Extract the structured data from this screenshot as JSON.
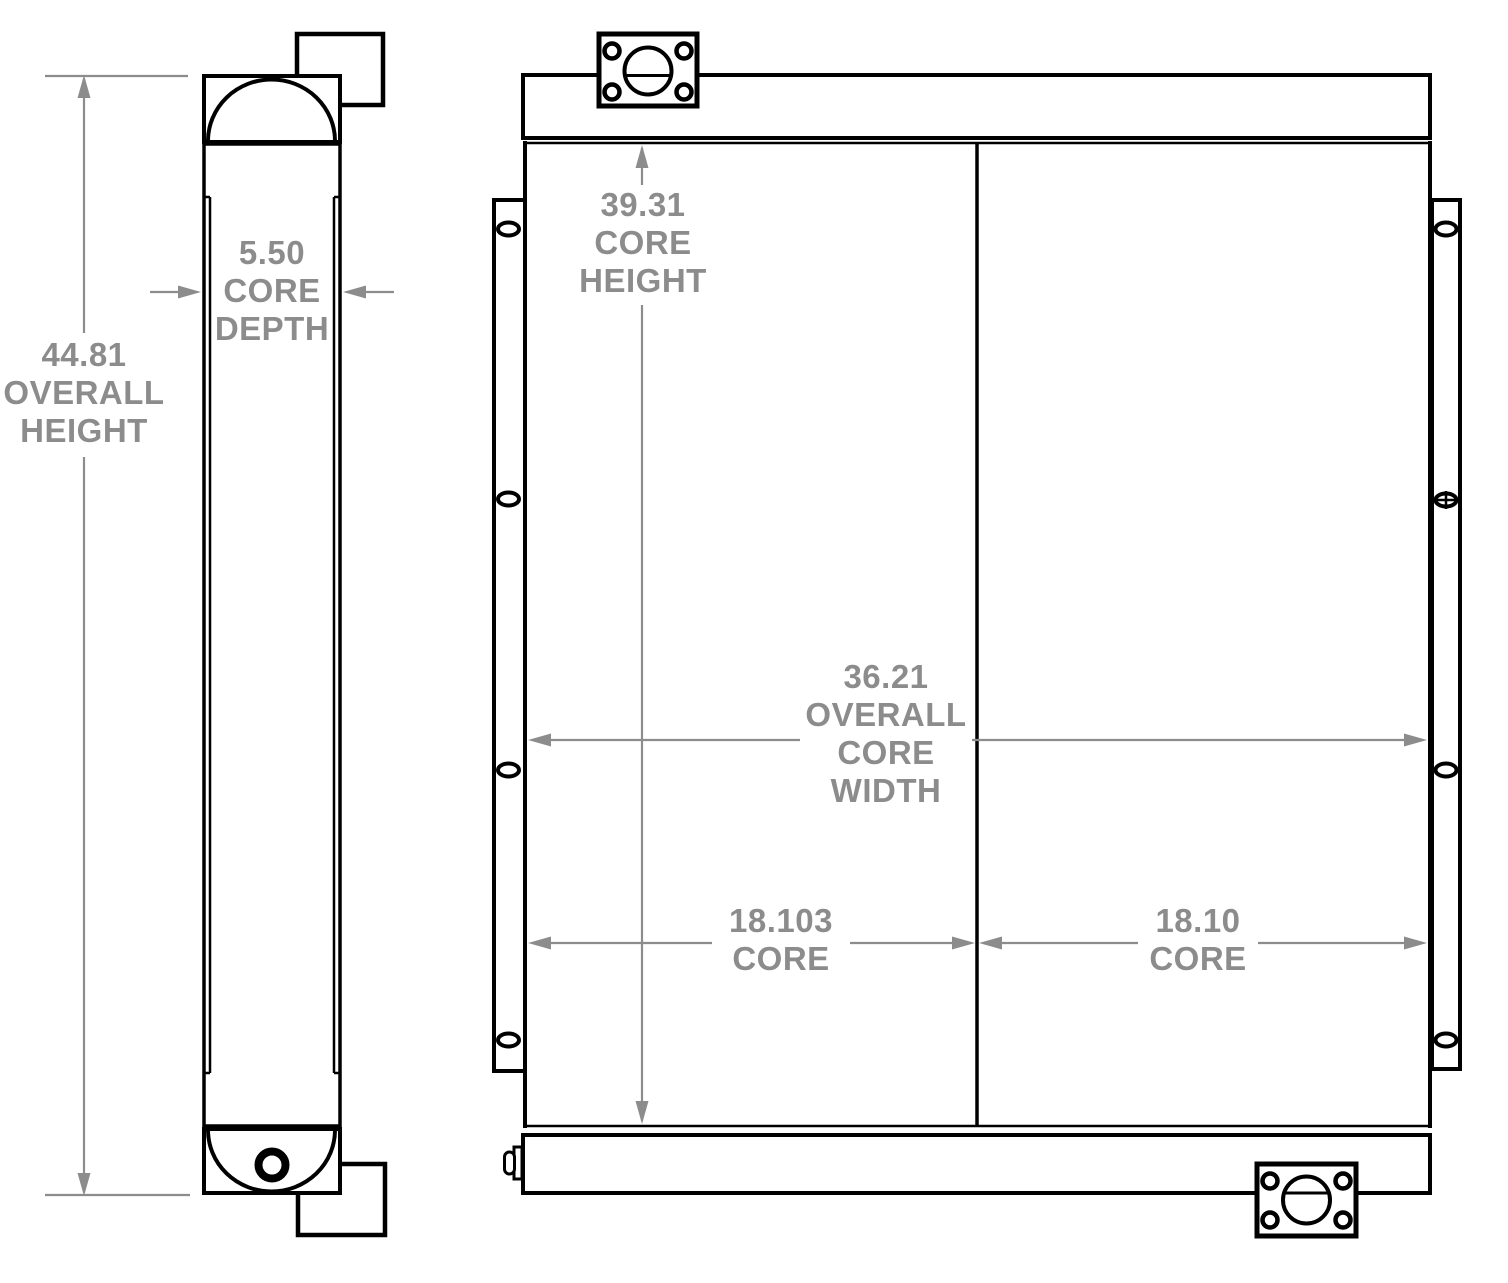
{
  "colors": {
    "background": "#ffffff",
    "part_line": "#000000",
    "dimension": "#8c8c8c"
  },
  "dimensions": {
    "overall_height": {
      "value": "44.81",
      "label": "OVERALL HEIGHT",
      "lines": [
        "44.81",
        "OVERALL",
        "HEIGHT"
      ]
    },
    "core_depth": {
      "value": "5.50",
      "label": "CORE DEPTH",
      "lines": [
        "5.50",
        "CORE",
        "DEPTH"
      ]
    },
    "core_height": {
      "value": "39.31",
      "label": "CORE HEIGHT",
      "lines": [
        "39.31",
        "CORE",
        "HEIGHT"
      ]
    },
    "overall_core_width": {
      "value": "36.21",
      "label": "OVERALL CORE WIDTH",
      "lines": [
        "36.21",
        "OVERALL",
        "CORE",
        "WIDTH"
      ]
    },
    "core_width_left": {
      "value": "18.103",
      "label": "CORE",
      "lines": [
        "18.103",
        "CORE"
      ]
    },
    "core_width_right": {
      "value": "18.10",
      "label": "CORE",
      "lines": [
        "18.10",
        "CORE"
      ]
    }
  }
}
